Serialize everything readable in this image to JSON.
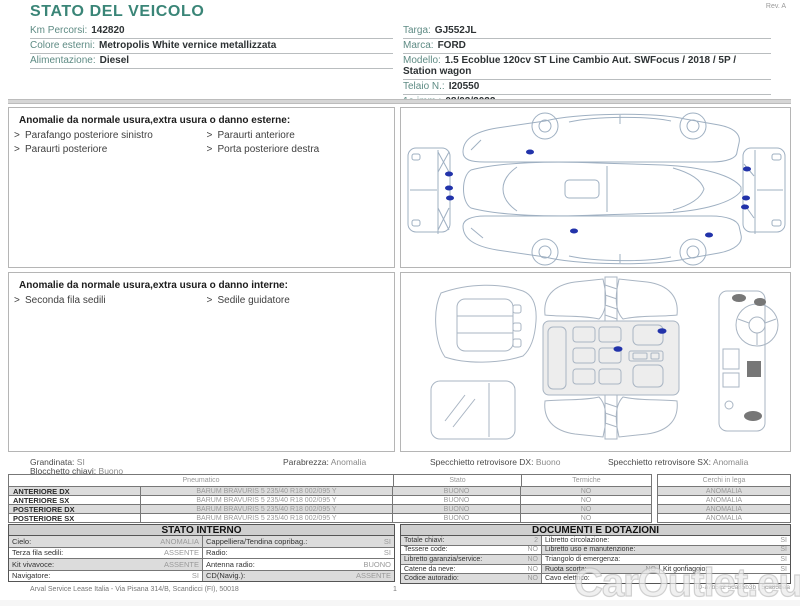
{
  "colors": {
    "accent_teal": "#3a8577",
    "damage_marker": "#2233aa",
    "row_shade": "#dcdcdc"
  },
  "header": {
    "title": "STATO DEL VEICOLO",
    "revision": "Rev. A",
    "left_fields": [
      {
        "label": "Km Percorsi:",
        "value": "142820"
      },
      {
        "label": "Colore esterni:",
        "value": "Metropolis White vernice metallizzata"
      },
      {
        "label": "Alimentazione:",
        "value": "Diesel"
      }
    ],
    "right_fields": [
      {
        "label": "Targa:",
        "value": "GJ552JL"
      },
      {
        "label": "Marca:",
        "value": "FORD"
      },
      {
        "label": "Modello:",
        "value": "1.5 Ecoblue 120cv ST Line Cambio Aut. SWFocus / 2018 / 5P / Station wagon"
      },
      {
        "label": "Telaio N.:",
        "value": "I20550"
      },
      {
        "label": "1a imm.:",
        "value": "08/03/2022"
      }
    ]
  },
  "exterior_anomalies": {
    "title": "Anomalie da normale usura,extra usura o danno esterne:",
    "column1": [
      "Parafango posteriore sinistro",
      "Paraurti posteriore"
    ],
    "column2": [
      "Paraurti anteriore",
      "Porta posteriore destra"
    ]
  },
  "interior_anomalies": {
    "title": "Anomalie da normale usura,extra usura o danno interne:",
    "column1": [
      "Seconda fila sedili"
    ],
    "column2": [
      "Sedile guidatore"
    ]
  },
  "summary": {
    "grandinata": {
      "label": "Grandinata:",
      "value": "SI"
    },
    "parabrezza": {
      "label": "Parabrezza:",
      "value": "Anomalia"
    },
    "specchietto_dx": {
      "label": "Specchietto retrovisore DX:",
      "value": "Buono"
    },
    "specchietto_sx": {
      "label": "Specchietto retrovisore SX:",
      "value": "Anomalia"
    },
    "blocchetto_chiavi": {
      "label": "Blocchetto chiavi:",
      "value": "Buono"
    }
  },
  "tyres": {
    "headers": {
      "pneumatico": "Pneumatico",
      "stato": "Stato",
      "termiche": "Termiche",
      "cerchi": "Cerchi in lega"
    },
    "rows": [
      {
        "position": "ANTERIORE DX",
        "spec": "BARUM BRAVURIS 5 235/40 R18 002/095 Y",
        "stato": "BUONO",
        "termiche": "NO",
        "cerchi": "ANOMALIA"
      },
      {
        "position": "ANTERIORE SX",
        "spec": "BARUM BRAVURIS 5 235/40 R18 002/095 Y",
        "stato": "BUONO",
        "termiche": "NO",
        "cerchi": "ANOMALIA"
      },
      {
        "position": "POSTERIORE DX",
        "spec": "BARUM BRAVURIS 5 235/40 R18 002/095 Y",
        "stato": "BUONO",
        "termiche": "NO",
        "cerchi": "ANOMALIA"
      },
      {
        "position": "POSTERIORE SX",
        "spec": "BARUM BRAVURIS 5 235/40 R18 002/095 Y",
        "stato": "BUONO",
        "termiche": "NO",
        "cerchi": "ANOMALIA"
      }
    ]
  },
  "stato_interno": {
    "title": "STATO INTERNO",
    "rows": [
      [
        {
          "label": "Cielo:",
          "value": "ANOMALIA"
        },
        {
          "label": "Cappelliera/Tendina copribag.:",
          "value": "SI"
        }
      ],
      [
        {
          "label": "Terza fila sedili:",
          "value": "ASSENTE"
        },
        {
          "label": "Radio:",
          "value": "SI"
        }
      ],
      [
        {
          "label": "Kit vivavoce:",
          "value": "ASSENTE"
        },
        {
          "label": "Antenna radio:",
          "value": "BUONO"
        }
      ],
      [
        {
          "label": "Navigatore:",
          "value": "SI"
        },
        {
          "label": "CD(Navig.):",
          "value": "ASSENTE"
        }
      ]
    ]
  },
  "documenti": {
    "title": "DOCUMENTI E DOTAZIONI",
    "rows": [
      [
        {
          "label": "Totale chiavi:",
          "value": "2"
        },
        {
          "label": "Libretto circolazione:",
          "value": "SI"
        }
      ],
      [
        {
          "label": "Tessere code:",
          "value": "NO"
        },
        {
          "label": "Libretto uso e manutenzione:",
          "value": "SI"
        }
      ],
      [
        {
          "label": "Libretto garanzia/service:",
          "value": "NO"
        },
        {
          "label": "Triangolo di emergenza:",
          "value": "SI"
        }
      ],
      [
        {
          "label": "Catene da neve:",
          "value": "NO"
        },
        {
          "label": "Ruota scorta:",
          "value": "NO"
        },
        {
          "label": "Kit gonfiaggio:",
          "value": "SI"
        }
      ],
      [
        {
          "label": "Codice autoradio:",
          "value": "NO"
        },
        {
          "label": "Cavo elettrico:",
          "value": ""
        }
      ]
    ]
  },
  "footer": {
    "company": "Arval Service Lease Italia - Via Pisana 314/B, Scandicci (FI), 50018",
    "page": "1",
    "document_id": "ID-a7b5c2 5ca85b3b | 5ca85baa"
  },
  "watermark": {
    "text": "CarOutlet.eu"
  }
}
